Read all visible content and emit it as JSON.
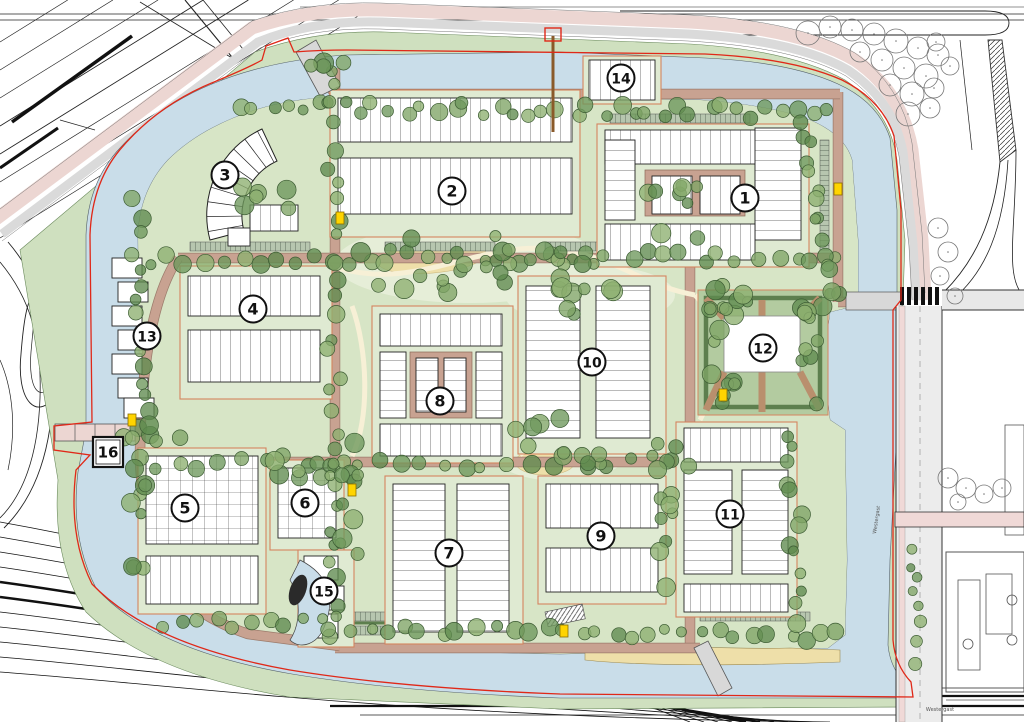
{
  "map": {
    "type": "residential-masterplan-site-plan",
    "block_markers": [
      {
        "id": "1",
        "x": 745,
        "y": 198,
        "shape": "circle"
      },
      {
        "id": "2",
        "x": 452,
        "y": 191,
        "shape": "circle"
      },
      {
        "id": "3",
        "x": 225,
        "y": 175,
        "shape": "circle"
      },
      {
        "id": "4",
        "x": 253,
        "y": 309,
        "shape": "circle"
      },
      {
        "id": "5",
        "x": 185,
        "y": 508,
        "shape": "circle"
      },
      {
        "id": "6",
        "x": 305,
        "y": 503,
        "shape": "circle"
      },
      {
        "id": "7",
        "x": 449,
        "y": 553,
        "shape": "circle"
      },
      {
        "id": "8",
        "x": 440,
        "y": 401,
        "shape": "circle"
      },
      {
        "id": "9",
        "x": 601,
        "y": 536,
        "shape": "circle"
      },
      {
        "id": "10",
        "x": 592,
        "y": 362,
        "shape": "circle"
      },
      {
        "id": "11",
        "x": 730,
        "y": 514,
        "shape": "circle"
      },
      {
        "id": "12",
        "x": 763,
        "y": 348,
        "shape": "circle"
      },
      {
        "id": "13",
        "x": 147,
        "y": 336,
        "shape": "circle"
      },
      {
        "id": "14",
        "x": 621,
        "y": 78,
        "shape": "circle"
      },
      {
        "id": "15",
        "x": 324,
        "y": 591,
        "shape": "circle"
      },
      {
        "id": "16",
        "x": 108,
        "y": 452,
        "shape": "square"
      }
    ],
    "street_labels": [
      {
        "text": "Westergast",
        "x": 940,
        "y": 711,
        "rotation": 0
      },
      {
        "text": "Westergast",
        "x": 878,
        "y": 520,
        "rotation": -82
      }
    ],
    "colors": {
      "water": "#c9dde9",
      "site_green": "#d7e5c6",
      "verge_green": "#cfe0bf",
      "meadow": "#e6eed8",
      "sand": "#eedfa9",
      "road_tan": "#c8a291",
      "ring_pink": "#ecd6d2",
      "ring_gray": "#dadada",
      "boundary_red": "#e02818",
      "tree_greens": [
        "#7fa465",
        "#6d975b",
        "#8db070",
        "#5f8a4e"
      ],
      "parcel_line": "#d4845f",
      "building_fill": "#ffffff",
      "utility_yellow": "#ffd400",
      "hedge_green": "#5d7f4e",
      "parking_gray_green": "#b7c6af"
    }
  }
}
